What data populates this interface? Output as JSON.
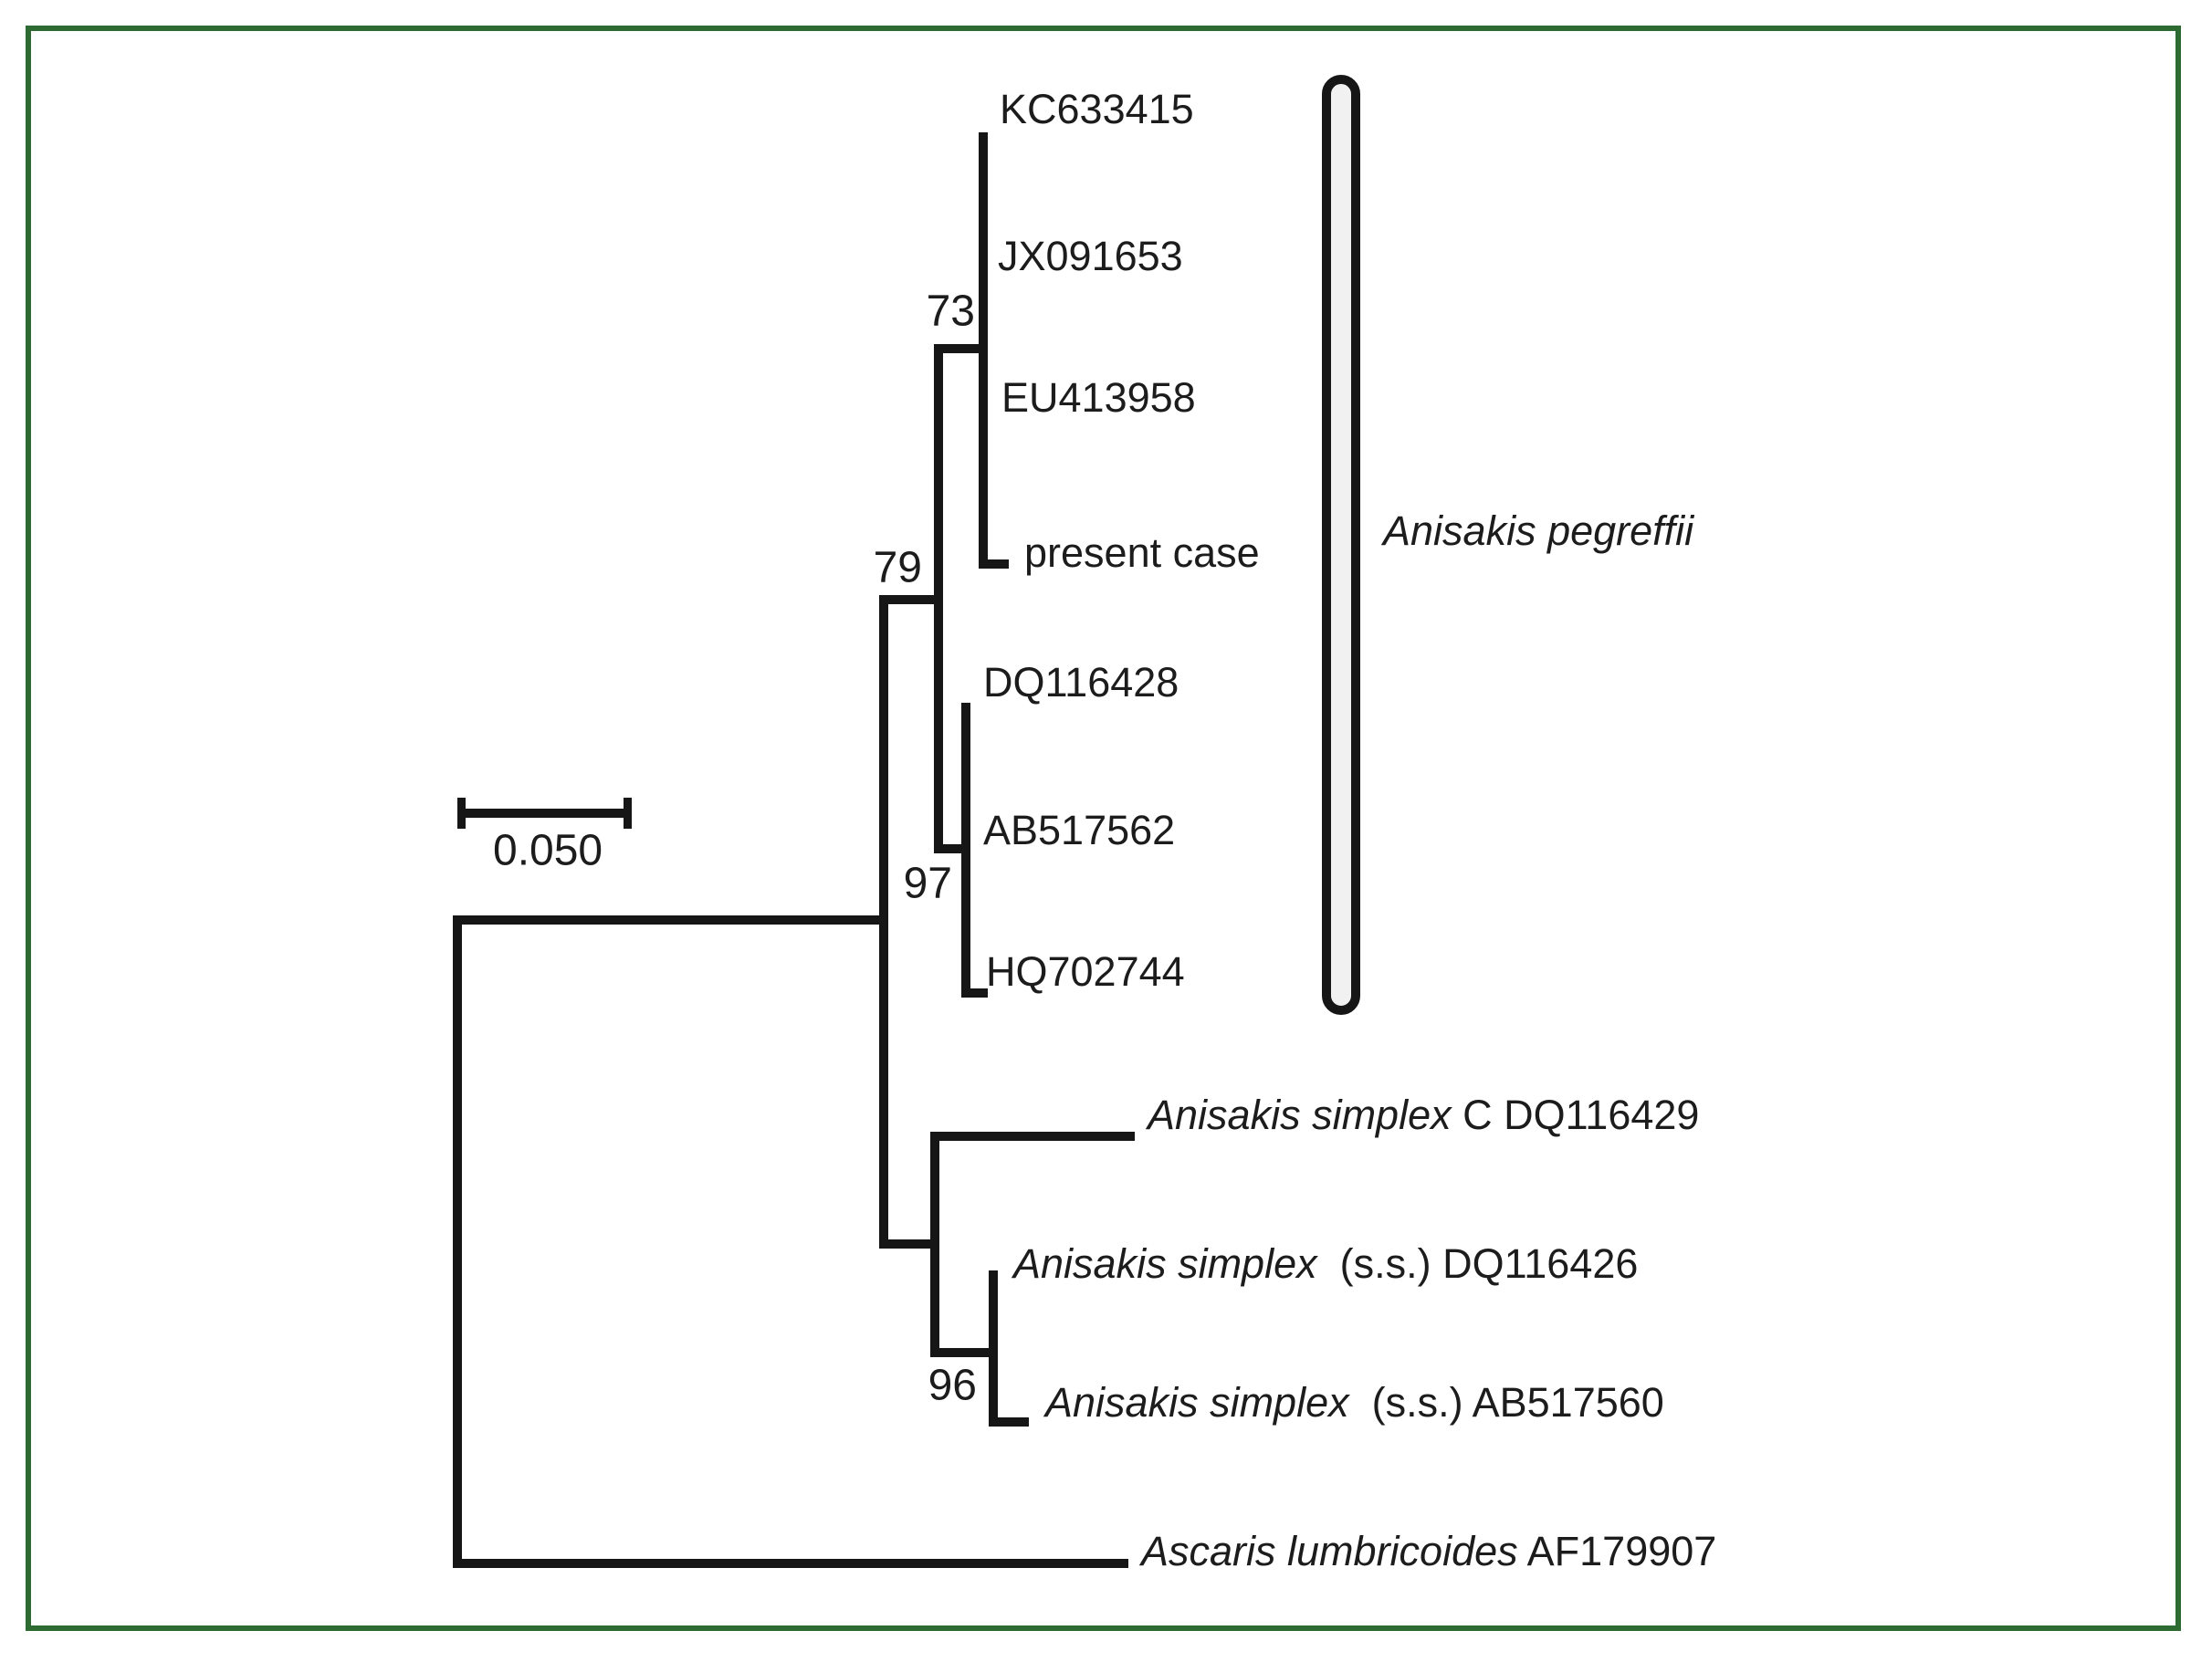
{
  "figure": {
    "type": "phylogenetic-tree",
    "scale_bar": {
      "label": "0.050"
    },
    "clade_bracket_label": {
      "italic": "Anisakis pegreffii",
      "rest": ""
    },
    "bootstrap": {
      "n73": "73",
      "n79": "79",
      "n97": "97",
      "n96": "96"
    },
    "tips": [
      {
        "italic": "",
        "rest": "KC633415"
      },
      {
        "italic": "",
        "rest": "JX091653"
      },
      {
        "italic": "",
        "rest": "EU413958"
      },
      {
        "italic": "",
        "rest": "present case"
      },
      {
        "italic": "",
        "rest": "DQ116428"
      },
      {
        "italic": "",
        "rest": "AB517562"
      },
      {
        "italic": "",
        "rest": "HQ702744"
      },
      {
        "italic": "Anisakis simplex",
        "rest": " C DQ116429"
      },
      {
        "italic": "Anisakis simplex",
        "rest": "  (s.s.) DQ116426"
      },
      {
        "italic": "Anisakis simplex",
        "rest": "  (s.s.) AB517560"
      },
      {
        "italic": "Ascaris lumbricoides",
        "rest": " AF179907"
      }
    ],
    "structure": {
      "clades": [
        {
          "support": "73",
          "members": [
            "KC633415",
            "JX091653",
            "EU413958",
            "present case"
          ]
        },
        {
          "support": "97",
          "members": [
            "DQ116428",
            "AB517562",
            "HQ702744"
          ]
        },
        {
          "support": "79",
          "members": [
            "clade-73",
            "clade-97"
          ],
          "bracket_label": "Anisakis pegreffii"
        },
        {
          "support": "96",
          "members": [
            "Anisakis simplex (s.s.) DQ116426",
            "Anisakis simplex (s.s.) AB517560"
          ]
        }
      ],
      "outgroup": "Ascaris lumbricoides AF179907"
    },
    "colors": {
      "frame": "#2e6b33",
      "line": "#161616",
      "text": "#1c1c1c",
      "capsule_fill": "#f1f1f1",
      "background": "#ffffff"
    }
  }
}
